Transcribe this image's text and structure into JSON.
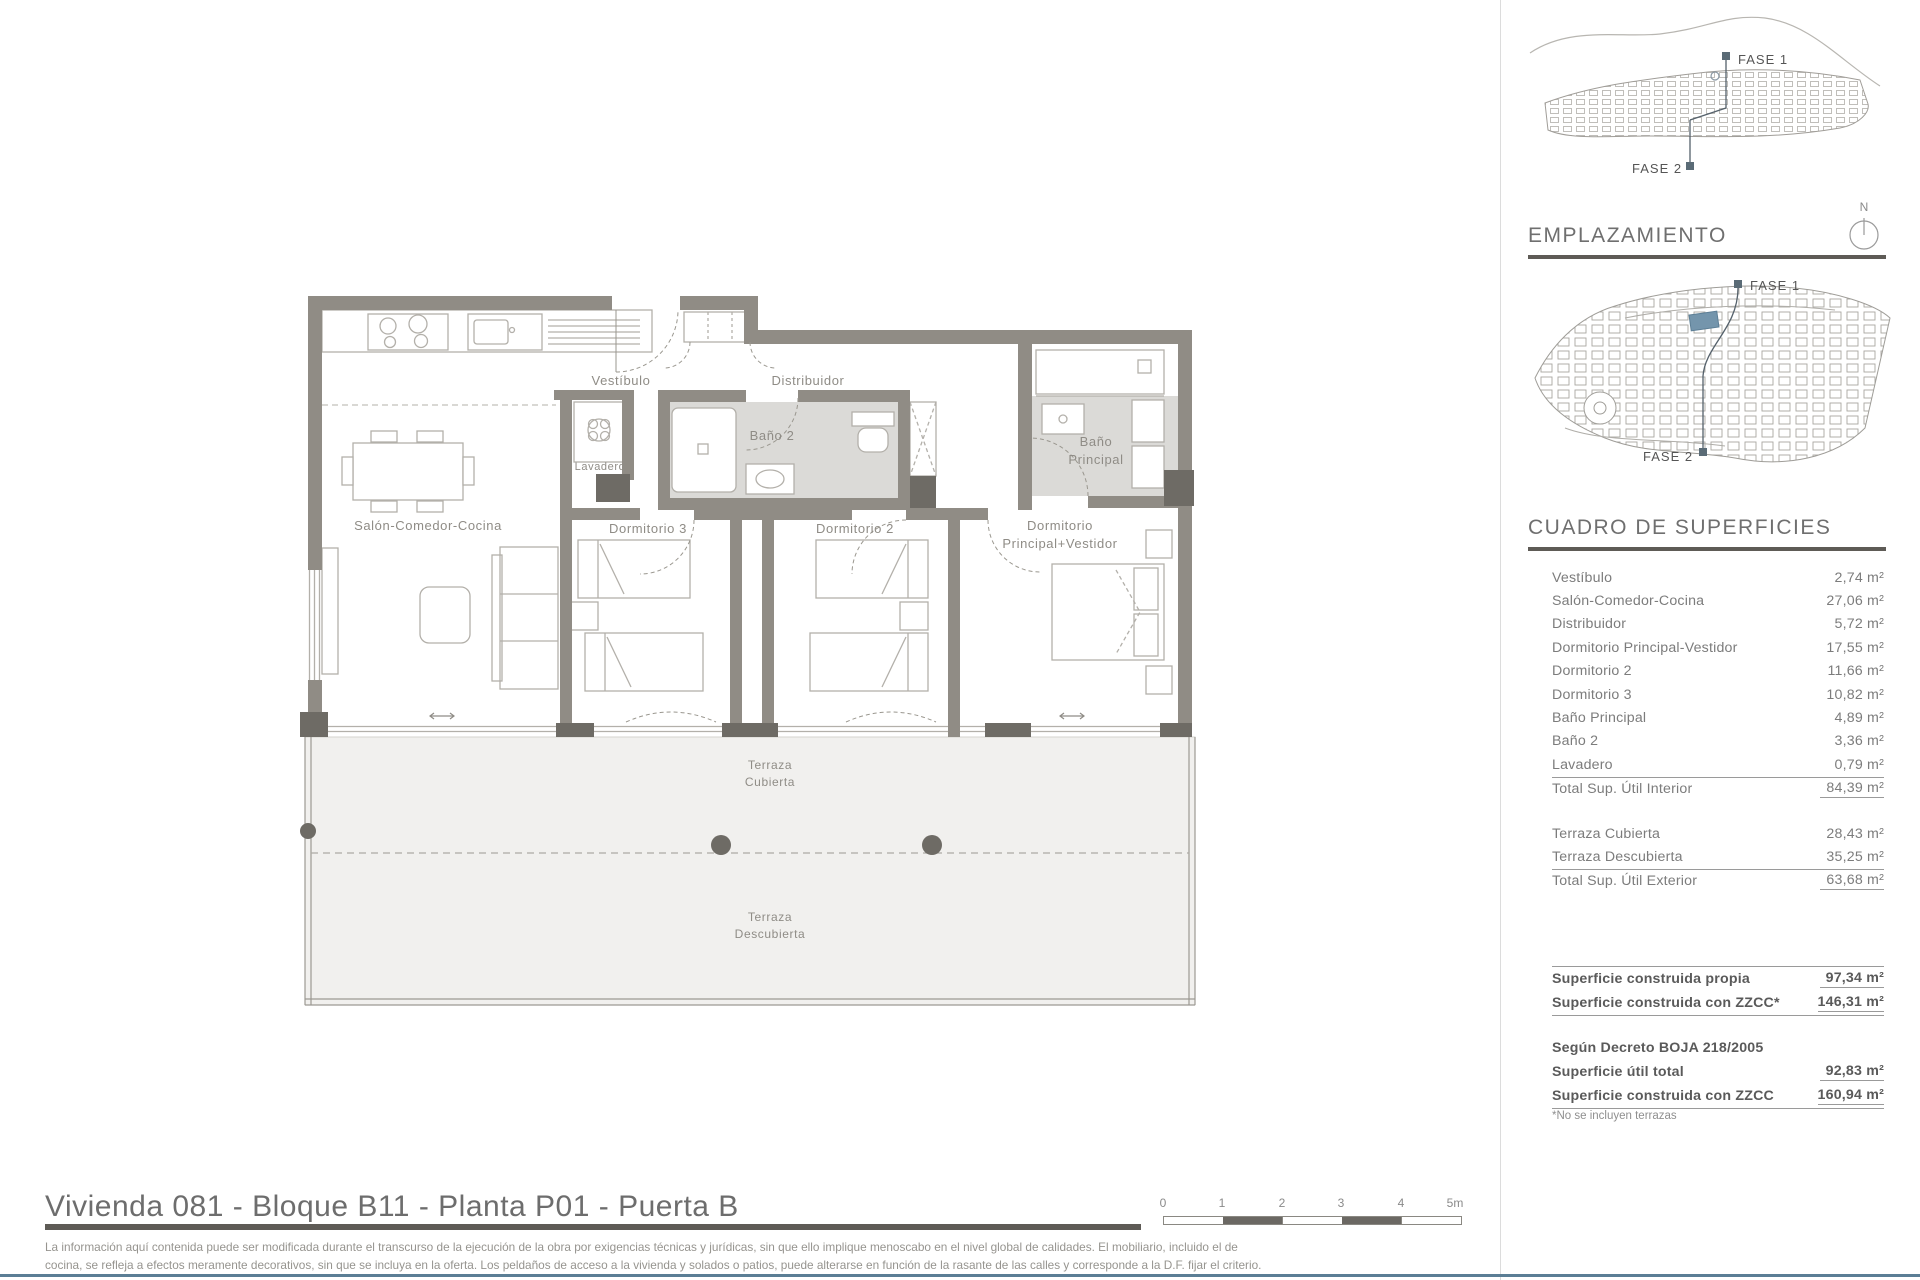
{
  "plan": {
    "labels": {
      "vestibulo": "Vestíbulo",
      "distribuidor": "Distribuidor",
      "bano2": "Baño 2",
      "lavadero": "Lavadero",
      "dorm3": "Dormitorio 3",
      "dorm2": "Dormitorio 2",
      "dormp_l1": "Dormitorio",
      "dormp_l2": "Principal+Vestidor",
      "banop_l1": "Baño",
      "banop_l2": "Principal",
      "salon": "Salón-Comedor-Cocina",
      "terraza_c1": "Terraza",
      "terraza_c2": "Cubierta",
      "terraza_d1": "Terraza",
      "terraza_d2": "Descubierta"
    }
  },
  "sidebar": {
    "map1": {
      "fase1_label": "FASE 1",
      "fase2_label": "FASE 2"
    },
    "emplazamiento_title": "EMPLAZAMIENTO",
    "compass_n": "N",
    "map2": {
      "fase1_label": "FASE 1",
      "fase2_label": "FASE 2"
    },
    "cuadro_title": "CUADRO DE SUPERFICIES",
    "cuadro": {
      "rows": [
        {
          "label": "Vestíbulo",
          "value": "2,74 m²"
        },
        {
          "label": "Salón-Comedor-Cocina",
          "value": "27,06 m²"
        },
        {
          "label": "Distribuidor",
          "value": "5,72 m²"
        },
        {
          "label": "Dormitorio Principal-Vestidor",
          "value": "17,55 m²"
        },
        {
          "label": "Dormitorio 2",
          "value": "11,66 m²"
        },
        {
          "label": "Dormitorio 3",
          "value": "10,82 m²"
        },
        {
          "label": "Baño Principal",
          "value": "4,89 m²"
        },
        {
          "label": "Baño 2",
          "value": "3,36 m²"
        },
        {
          "label": "Lavadero",
          "value": "0,79 m²"
        }
      ],
      "total_interior": {
        "label": "Total Sup. Útil Interior",
        "value": "84,39 m²"
      },
      "rows_ext": [
        {
          "label": "Terraza Cubierta",
          "value": "28,43 m²"
        },
        {
          "label": "Terraza Descubierta",
          "value": "35,25 m²"
        }
      ],
      "total_exterior": {
        "label": "Total Sup. Útil Exterior",
        "value": "63,68 m²"
      },
      "construida": [
        {
          "label": "Superficie construida propia",
          "value": "97,34 m²"
        },
        {
          "label": "Superficie construida con ZZCC*",
          "value": "146,31 m²"
        }
      ],
      "decreto_heading": "Según Decreto BOJA 218/2005",
      "decreto_rows": [
        {
          "label": "Superficie útil total",
          "value": "92,83 m²"
        },
        {
          "label": "Superficie construida con ZZCC",
          "value": "160,94 m²"
        }
      ],
      "footnote": "*No se incluyen terrazas"
    }
  },
  "footer": {
    "title": "Vivienda 081 - Bloque B11 - Planta P01 - Puerta B",
    "scale_labels": [
      "0",
      "1",
      "2",
      "3",
      "4",
      "5m"
    ],
    "disclaimer_line1": "La información aquí contenida puede  ser modificada durante el transcurso de la ejecución de la obra por exigencias técnicas y jurídicas,  sin  que  ello  implique  menoscabo  en el nivel global de calidades.  El  mobiliario, incluido el de",
    "disclaimer_line2": "cocina, se refleja a efectos meramente decorativos, sin que se incluya en la oferta. Los peldaños de acceso a la vivienda y  solados  o patios,  puede alterarse  en función de la rasante de las calles y corresponde a  la  D.F.  fijar el criterio."
  },
  "colors": {
    "wall": "#908C85",
    "pier": "#6E6B65",
    "bath_floor": "#DBDAD7",
    "terrace_fill": "#F1F0EE",
    "highlight_blue": "#7495AC",
    "heading_bar": "#5E5B56",
    "footer_line": "#5B7E95"
  }
}
